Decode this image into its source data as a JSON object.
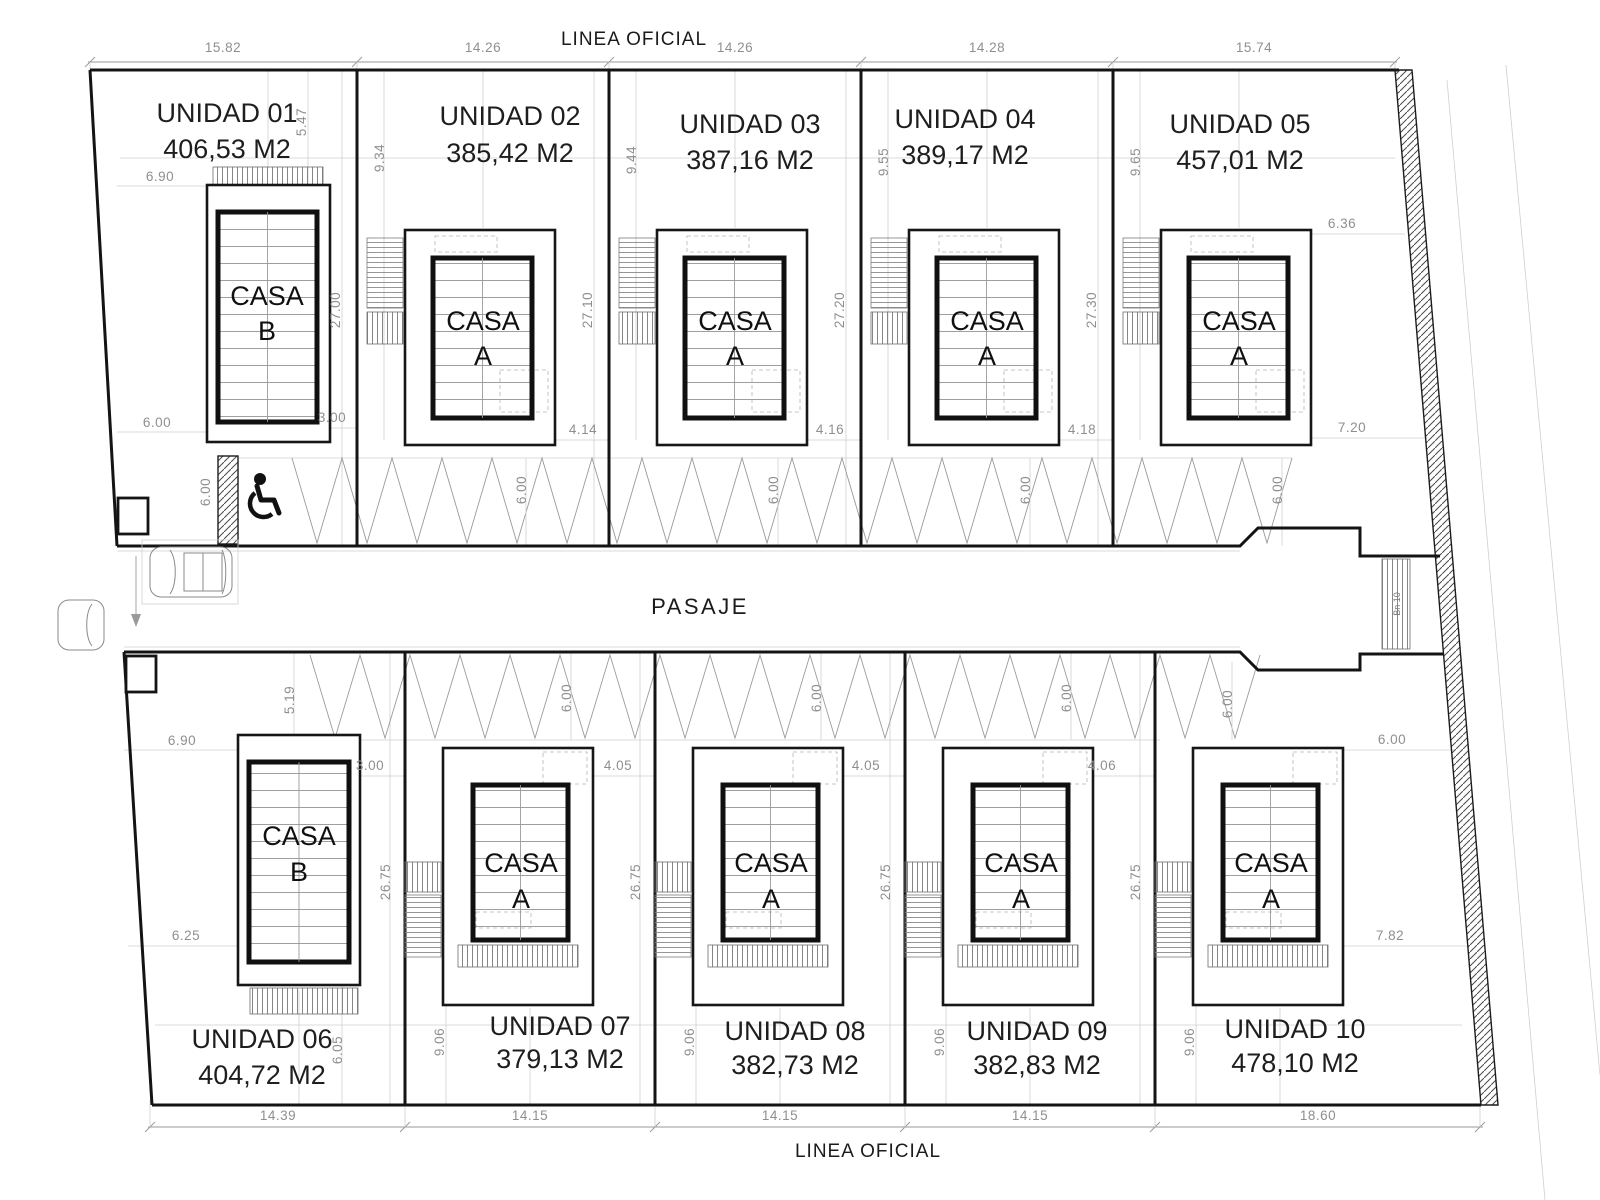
{
  "titles": {
    "linea_oficial_top": "LINEA OFICIAL",
    "linea_oficial_bottom": "LINEA OFICIAL",
    "pasaje": "PASAJE",
    "stair_note": "Bn 10"
  },
  "top_dims": [
    "15.82",
    "14.26",
    "14.26",
    "14.28",
    "15.74"
  ],
  "bottom_dims": [
    "14.39",
    "14.15",
    "14.15",
    "14.15",
    "18.60"
  ],
  "units": [
    {
      "id": "01",
      "name": "UNIDAD 01",
      "area": "406,53 M2",
      "casa1": "CASA",
      "casa2": "B"
    },
    {
      "id": "02",
      "name": "UNIDAD 02",
      "area": "385,42 M2",
      "casa1": "CASA",
      "casa2": "A"
    },
    {
      "id": "03",
      "name": "UNIDAD 03",
      "area": "387,16 M2",
      "casa1": "CASA",
      "casa2": "A"
    },
    {
      "id": "04",
      "name": "UNIDAD 04",
      "area": "389,17 M2",
      "casa1": "CASA",
      "casa2": "A"
    },
    {
      "id": "05",
      "name": "UNIDAD 05",
      "area": "457,01 M2",
      "casa1": "CASA",
      "casa2": "A"
    },
    {
      "id": "06",
      "name": "UNIDAD 06",
      "area": "404,72 M2",
      "casa1": "CASA",
      "casa2": "B"
    },
    {
      "id": "07",
      "name": "UNIDAD 07",
      "area": "379,13 M2",
      "casa1": "CASA",
      "casa2": "A"
    },
    {
      "id": "08",
      "name": "UNIDAD 08",
      "area": "382,73 M2",
      "casa1": "CASA",
      "casa2": "A"
    },
    {
      "id": "09",
      "name": "UNIDAD 09",
      "area": "382,83 M2",
      "casa1": "CASA",
      "casa2": "A"
    },
    {
      "id": "10",
      "name": "UNIDAD 10",
      "area": "478,10 M2",
      "casa1": "CASA",
      "casa2": "A"
    }
  ],
  "dims": {
    "u01_front": "5.47",
    "u01_side": "6.90",
    "u01_side2": "6.00",
    "u01_gap": "3.00",
    "u01_park": "6.00",
    "w02": "9.34",
    "w03": "9.44",
    "w04": "9.55",
    "w05": "9.65",
    "d01": "27.00",
    "d02": "27.10",
    "d03": "27.20",
    "d04": "27.30",
    "park02": "6.00",
    "park03": "6.00",
    "park04": "6.00",
    "park05": "6.00",
    "gap02": "4.14",
    "gap03": "4.16",
    "gap04": "4.18",
    "u05_side": "7.20",
    "u05_front": "6.36",
    "u06_front": "5.19",
    "u06_side": "6.90",
    "u06_side2": "6.25",
    "u06_gap": "3.00",
    "u06_rear": "6.05",
    "w07": "9.06",
    "w08": "9.06",
    "w09": "9.06",
    "w10": "9.06",
    "d07": "26.75",
    "d08": "26.75",
    "d09": "26.75",
    "d10": "26.75",
    "park07": "6.00",
    "park08": "6.00",
    "park09": "6.00",
    "park10": "6.00",
    "gap07": "4.05",
    "gap08": "4.05",
    "gap09": "4.06",
    "u10_side": "6.00",
    "u10_rear": "7.82"
  },
  "colors": {
    "line": "#141414",
    "dim_text": "#8f8f8f",
    "background": "#ffffff"
  }
}
